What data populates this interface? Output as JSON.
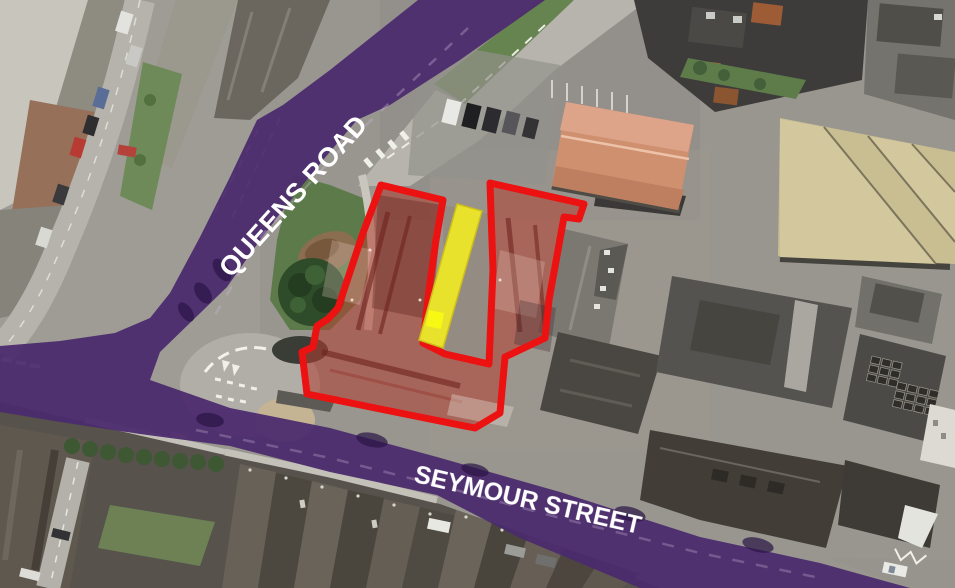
{
  "map": {
    "type": "annotated-aerial-photo",
    "roads": [
      {
        "id": "queens-road",
        "label": "QUEENS ROAD",
        "highlight_color": "#4b2a6d",
        "label_color": "#ffffff"
      },
      {
        "id": "seymour-street",
        "label": "SEYMOUR STREET",
        "highlight_color": "#4b2a6d",
        "label_color": "#ffffff"
      }
    ],
    "overlays": [
      {
        "id": "site-boundary",
        "style": "outline",
        "color": "#ec1212",
        "fill": "rgba(178,62,48,0.55)"
      },
      {
        "id": "highlighted-lane",
        "style": "filled-strip",
        "color": "#e9e22c"
      }
    ]
  }
}
